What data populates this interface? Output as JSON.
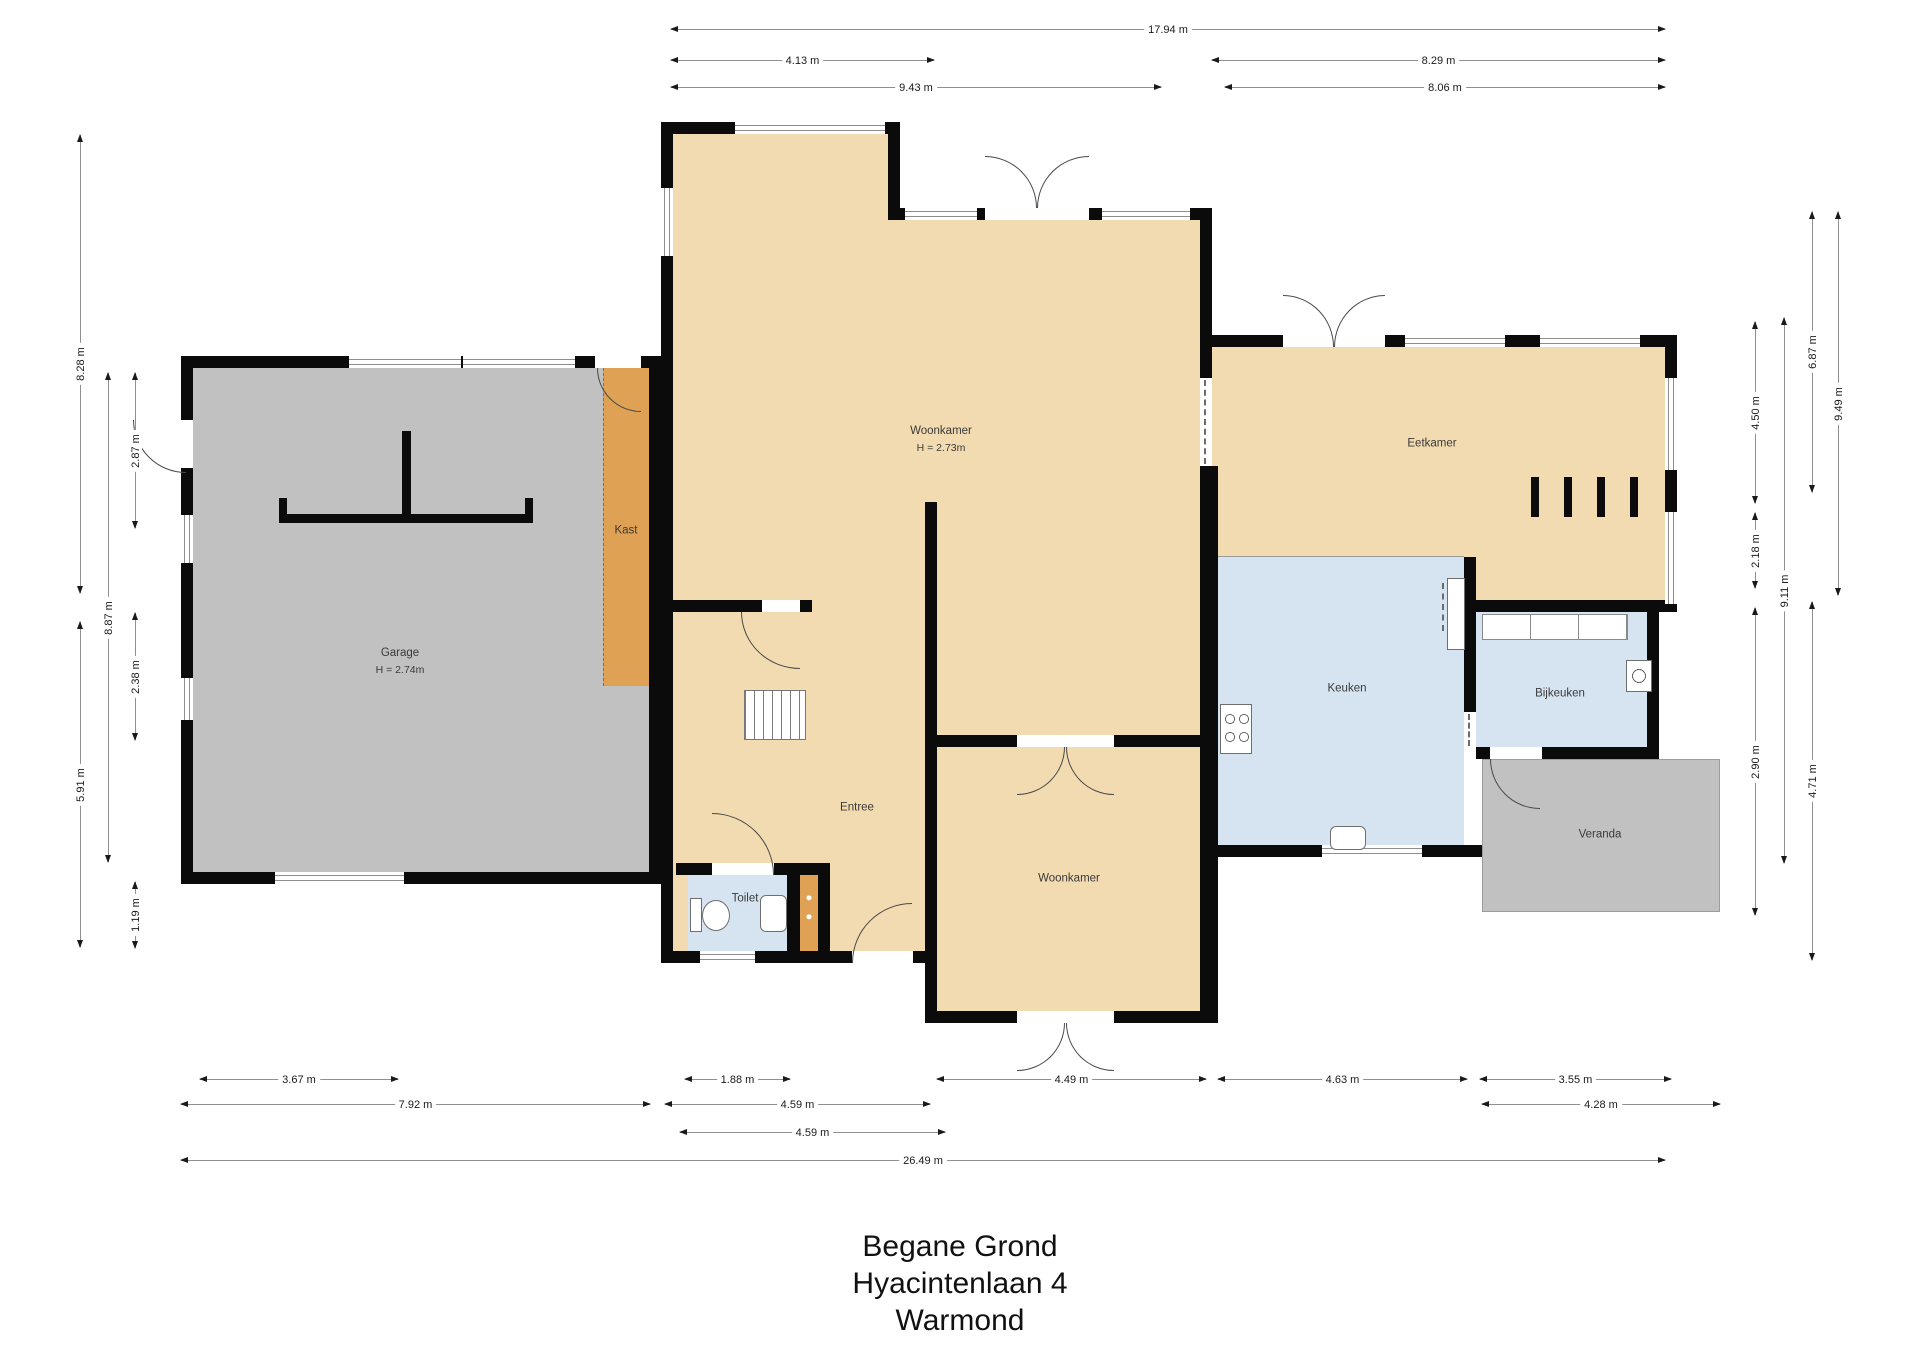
{
  "title": {
    "line1": "Begane Grond",
    "line2": "Hyacintenlaan 4",
    "line3": "Warmond"
  },
  "rooms": [
    {
      "id": "garage",
      "label": "Garage",
      "sublabel": "H = 2.74m",
      "x": 400,
      "y": 662
    },
    {
      "id": "kast",
      "label": "Kast",
      "x": 626,
      "y": 531
    },
    {
      "id": "woonkamer",
      "label": "Woonkamer",
      "sublabel": "H = 2.73m",
      "x": 941,
      "y": 440
    },
    {
      "id": "eetkamer",
      "label": "Eetkamer",
      "x": 1432,
      "y": 444
    },
    {
      "id": "keuken",
      "label": "Keuken",
      "x": 1347,
      "y": 689
    },
    {
      "id": "bijkeuken",
      "label": "Bijkeuken",
      "x": 1560,
      "y": 694
    },
    {
      "id": "veranda",
      "label": "Veranda",
      "x": 1600,
      "y": 835
    },
    {
      "id": "entree",
      "label": "Entree",
      "x": 857,
      "y": 808
    },
    {
      "id": "toilet",
      "label": "Toilet",
      "x": 745,
      "y": 899
    },
    {
      "id": "woonkamer-2",
      "label": "Woonkamer",
      "x": 1069,
      "y": 879
    }
  ],
  "dimensions": [
    {
      "label": "17.94 m",
      "dir": "h",
      "x1": 671,
      "x2": 1665,
      "y": 29
    },
    {
      "label": "4.13 m",
      "dir": "h",
      "x1": 671,
      "x2": 934,
      "y": 60
    },
    {
      "label": "8.29 m",
      "dir": "h",
      "x1": 1212,
      "x2": 1665,
      "y": 60
    },
    {
      "label": "9.43 m",
      "dir": "h",
      "x1": 671,
      "x2": 1161,
      "y": 87
    },
    {
      "label": "8.06 m",
      "dir": "h",
      "x1": 1225,
      "x2": 1665,
      "y": 87
    },
    {
      "label": "3.67 m",
      "dir": "h",
      "x1": 200,
      "x2": 398,
      "y": 1079
    },
    {
      "label": "1.88 m",
      "dir": "h",
      "x1": 685,
      "x2": 790,
      "y": 1079
    },
    {
      "label": "4.49 m",
      "dir": "h",
      "x1": 937,
      "x2": 1206,
      "y": 1079
    },
    {
      "label": "4.63 m",
      "dir": "h",
      "x1": 1218,
      "x2": 1467,
      "y": 1079
    },
    {
      "label": "3.55 m",
      "dir": "h",
      "x1": 1480,
      "x2": 1671,
      "y": 1079
    },
    {
      "label": "7.92 m",
      "dir": "h",
      "x1": 181,
      "x2": 650,
      "y": 1104
    },
    {
      "label": "4.59 m",
      "dir": "h",
      "x1": 665,
      "x2": 930,
      "y": 1104
    },
    {
      "label": "4.28 m",
      "dir": "h",
      "x1": 1482,
      "x2": 1720,
      "y": 1104
    },
    {
      "label": "4.59 m",
      "dir": "h",
      "x1": 680,
      "x2": 945,
      "y": 1132
    },
    {
      "label": "26.49 m",
      "dir": "h",
      "x1": 181,
      "x2": 1665,
      "y": 1160
    },
    {
      "label": "8.28 m",
      "dir": "v",
      "x": 80,
      "y1": 135,
      "y2": 593
    },
    {
      "label": "5.91 m",
      "dir": "v",
      "x": 80,
      "y1": 622,
      "y2": 947
    },
    {
      "label": "8.87 m",
      "dir": "v",
      "x": 108,
      "y1": 373,
      "y2": 862
    },
    {
      "label": "2.87 m",
      "dir": "v",
      "x": 135,
      "y1": 373,
      "y2": 528
    },
    {
      "label": "2.38 m",
      "dir": "v",
      "x": 135,
      "y1": 613,
      "y2": 740
    },
    {
      "label": "1.19 m",
      "dir": "v",
      "x": 135,
      "y1": 882,
      "y2": 948
    },
    {
      "label": "4.50 m",
      "dir": "v",
      "x": 1755,
      "y1": 322,
      "y2": 503
    },
    {
      "label": "2.18 m",
      "dir": "v",
      "x": 1755,
      "y1": 513,
      "y2": 588
    },
    {
      "label": "2.90 m",
      "dir": "v",
      "x": 1755,
      "y1": 608,
      "y2": 915
    },
    {
      "label": "9.11 m",
      "dir": "v",
      "x": 1784,
      "y1": 318,
      "y2": 863
    },
    {
      "label": "6.87 m",
      "dir": "v",
      "x": 1812,
      "y1": 212,
      "y2": 492
    },
    {
      "label": "4.71 m",
      "dir": "v",
      "x": 1812,
      "y1": 602,
      "y2": 960
    },
    {
      "label": "9.49 m",
      "dir": "v",
      "x": 1838,
      "y1": 212,
      "y2": 595
    }
  ],
  "colors": {
    "floor_tan": "#F2DBB0",
    "floor_gray": "#C1C1C1",
    "floor_blue": "#D6E4F1",
    "closet_orange": "#DFA153",
    "wall": "#0B0B0B"
  }
}
